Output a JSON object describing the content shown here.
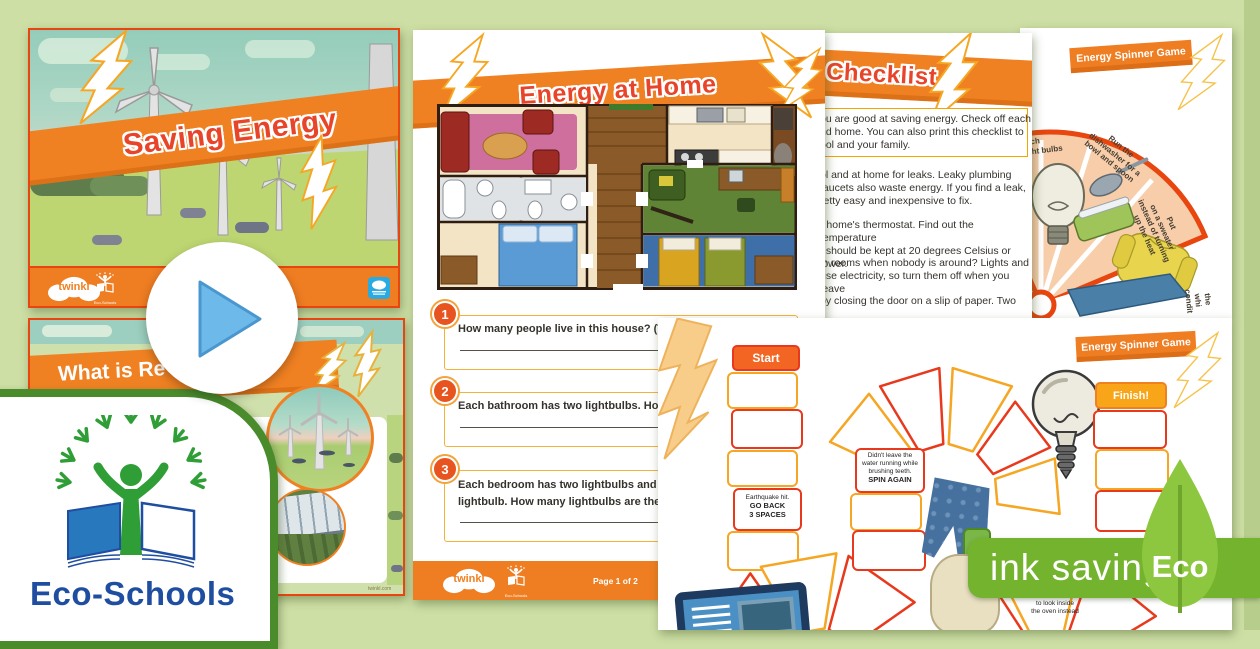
{
  "colors": {
    "bg": "#cddfa5",
    "accent_orange": "#f08122",
    "accent_red": "#e8391d",
    "badge_green": "#74b32d",
    "leaf_green": "#8dc63f",
    "play_blue": "#6db9e9",
    "eco_blue": "#1f4ea1",
    "eco_green": "#2f9e36"
  },
  "slide1": {
    "title": "Saving Energy",
    "brand": "twinkl",
    "eco_caption": "Eco-Schools"
  },
  "slide2": {
    "title_partial": "What is Re",
    "site_note": "twinkl.com"
  },
  "eco_card": {
    "label": "Eco-Schools"
  },
  "worksheet": {
    "title": "Energy at Home",
    "q1_num": "1",
    "q1_text": "How many people live in this house? (Tip: Count th",
    "q2_num": "2",
    "q2_text": "Each bathroom has two lightbulbs. How many ligh",
    "q3_num": "3",
    "q3_line1": "Each bedroom has two lightbulbs and each wardrob",
    "q3_line2": "lightbulb. How many lightbulbs are there altogethe",
    "brand": "twinkl",
    "eco_caption": "Eco-Schools",
    "page_label": "Page 1 of 2"
  },
  "checklist": {
    "title": "Checklist",
    "intro": [
      "ou are good at saving energy. Check off each",
      "nd home. You can also print this checklist to",
      "ool and your family."
    ],
    "item1": [
      "ol and at home for leaks. Leaky plumbing",
      "faucets also waste energy. If you find a leak,",
      "retty easy and inexpensive to fix."
    ],
    "item2": [
      "r home's thermostat. Find out the temperature",
      "t should be kept at 20 degrees Celsius or lower."
    ],
    "item3": [
      "in rooms when nobody is around? Lights and",
      "use electricity, so turn them off when you leave"
    ],
    "item4": [
      "by closing the door on a slip of paper. Two"
    ]
  },
  "spinner": {
    "banner": "Energy Spinner Game",
    "seg1": [
      "itch",
      "ght bulbs"
    ],
    "seg2": [
      "Run the",
      "dishwasher for a",
      "bowl and spoon"
    ],
    "seg3": [
      "Put",
      "on a sweater",
      "instead of turning",
      "up the heat"
    ],
    "seg4": [
      "the",
      "whi",
      "condit"
    ]
  },
  "board": {
    "banner": "Energy Spinner Game",
    "start": "Start",
    "finish": "Finish!",
    "earthquake": [
      "Earthquake hit.",
      "GO BACK",
      "3 SPACES"
    ],
    "water": [
      "Didn't leave the",
      "water running while",
      "brushing teeth.",
      "SPIN AGAIN"
    ],
    "oven": [
      "Used",
      "the window",
      "to look inside",
      "the oven instead"
    ]
  },
  "ink_badge": {
    "label": "ink saving",
    "eco": "Eco"
  }
}
